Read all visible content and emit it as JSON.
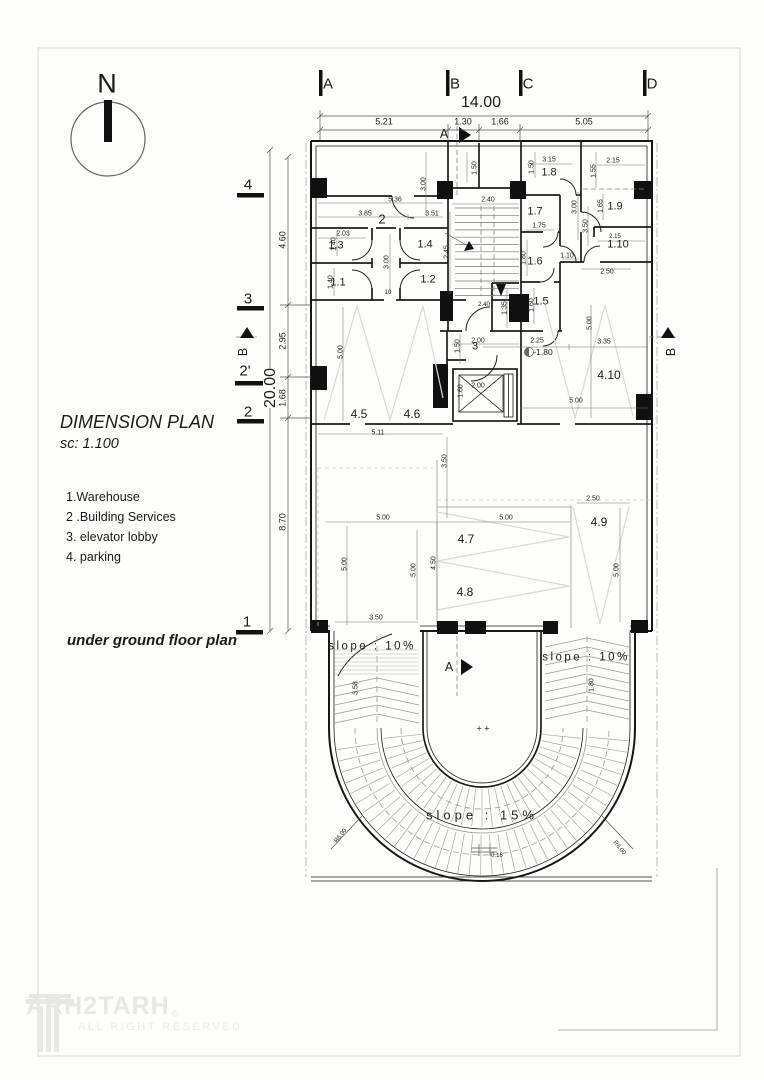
{
  "page": {
    "title": "DIMENSION PLAN",
    "scale": "sc: 1.100",
    "caption": "under ground floor plan"
  },
  "north": {
    "label": "N"
  },
  "legend": {
    "items": [
      "1.Warehouse",
      "2 .Building Services",
      "3. elevator lobby",
      "4. parking"
    ]
  },
  "watermark": {
    "brand": "ARH2TARH",
    "copyright": "©",
    "tagline": "ALL RIGHT RESERVED"
  },
  "annotations": {
    "grid_top": [
      {
        "t": "A",
        "x": 328,
        "y": 84
      },
      {
        "t": "B",
        "x": 455,
        "y": 84
      },
      {
        "t": "C",
        "x": 528,
        "y": 84
      },
      {
        "t": "D",
        "x": 652,
        "y": 84
      }
    ],
    "grid_left": [
      {
        "t": "4",
        "x": 248,
        "y": 185
      },
      {
        "t": "3",
        "x": 248,
        "y": 299
      },
      {
        "t": "2'",
        "x": 245,
        "y": 371
      },
      {
        "t": "2",
        "x": 248,
        "y": 412
      },
      {
        "t": "1",
        "x": 247,
        "y": 622
      }
    ],
    "big": [
      {
        "t": "14.00",
        "x": 481,
        "y": 103
      },
      {
        "t": "20.00",
        "x": 271,
        "y": 388,
        "r": -90,
        "bg": 1
      }
    ],
    "dims": [
      {
        "t": "5.21",
        "x": 384,
        "y": 122,
        "s": 9
      },
      {
        "t": "1.30",
        "x": 463,
        "y": 122,
        "s": 9
      },
      {
        "t": "1.66",
        "x": 500,
        "y": 122,
        "s": 9
      },
      {
        "t": "5.05",
        "x": 584,
        "y": 122,
        "s": 9
      },
      {
        "t": "4.60",
        "x": 283,
        "y": 240,
        "r": -90,
        "s": 9
      },
      {
        "t": "2.95",
        "x": 283,
        "y": 341,
        "r": -90,
        "s": 9
      },
      {
        "t": "1.68",
        "x": 283,
        "y": 398,
        "r": -90,
        "s": 9
      },
      {
        "t": "8.70",
        "x": 283,
        "y": 522,
        "r": -90,
        "s": 9
      },
      {
        "t": "5.36",
        "x": 395,
        "y": 200
      },
      {
        "t": "3.85",
        "x": 365,
        "y": 214
      },
      {
        "t": "3.51",
        "x": 432,
        "y": 214
      },
      {
        "t": "3.00",
        "x": 424,
        "y": 184,
        "r": -90
      },
      {
        "t": "2.03",
        "x": 343,
        "y": 234
      },
      {
        "t": "1.40",
        "x": 334,
        "y": 244,
        "r": -90
      },
      {
        "t": "1.40",
        "x": 331,
        "y": 282,
        "r": -90
      },
      {
        "t": "3.00",
        "x": 387,
        "y": 262,
        "r": -90
      },
      {
        "t": "10",
        "x": 388,
        "y": 293,
        "s": 6
      },
      {
        "t": "2.40",
        "x": 488,
        "y": 200
      },
      {
        "t": "2.45",
        "x": 447,
        "y": 252,
        "r": -90
      },
      {
        "t": "2.40",
        "x": 484,
        "y": 305,
        "s": 6
      },
      {
        "t": "1.50",
        "x": 475,
        "y": 168,
        "r": -90
      },
      {
        "t": "3.15",
        "x": 549,
        "y": 160
      },
      {
        "t": "1.50",
        "x": 532,
        "y": 167,
        "r": -90
      },
      {
        "t": "1.75",
        "x": 539,
        "y": 226
      },
      {
        "t": "3.00",
        "x": 575,
        "y": 207,
        "r": -90
      },
      {
        "t": "3.50",
        "x": 586,
        "y": 226,
        "r": -90
      },
      {
        "t": "2.15",
        "x": 613,
        "y": 161
      },
      {
        "t": "1.55",
        "x": 594,
        "y": 171,
        "r": -90
      },
      {
        "t": "1.65",
        "x": 601,
        "y": 206,
        "r": -90
      },
      {
        "t": "2.15",
        "x": 615,
        "y": 237,
        "s": 6
      },
      {
        "t": "2.50",
        "x": 607,
        "y": 272
      },
      {
        "t": "1.10",
        "x": 567,
        "y": 256
      },
      {
        "t": "1.80",
        "x": 524,
        "y": 258,
        "r": -90
      },
      {
        "t": "1.35",
        "x": 505,
        "y": 308,
        "r": -90
      },
      {
        "t": "1.60",
        "x": 532,
        "y": 305,
        "r": -90
      },
      {
        "t": "2.25",
        "x": 537,
        "y": 341
      },
      {
        "t": "2.00",
        "x": 478,
        "y": 341
      },
      {
        "t": "1.50",
        "x": 458,
        "y": 346,
        "r": -90
      },
      {
        "t": "3.35",
        "x": 604,
        "y": 342
      },
      {
        "t": "5.00",
        "x": 590,
        "y": 323,
        "r": -90
      },
      {
        "t": "2.00",
        "x": 478,
        "y": 386
      },
      {
        "t": "1.60",
        "x": 461,
        "y": 391,
        "r": -90
      },
      {
        "t": "5.00",
        "x": 576,
        "y": 401
      },
      {
        "t": "5.00",
        "x": 341,
        "y": 352,
        "r": -90
      },
      {
        "t": "5.11",
        "x": 378,
        "y": 433
      },
      {
        "t": "3.50",
        "x": 445,
        "y": 461,
        "r": -90
      },
      {
        "t": "5.00",
        "x": 383,
        "y": 518
      },
      {
        "t": "5.00",
        "x": 345,
        "y": 564,
        "r": -90
      },
      {
        "t": "5.00",
        "x": 414,
        "y": 570,
        "r": -90
      },
      {
        "t": "4.50",
        "x": 434,
        "y": 563,
        "r": -90
      },
      {
        "t": "3.50",
        "x": 376,
        "y": 618
      },
      {
        "t": "2.50",
        "x": 593,
        "y": 499
      },
      {
        "t": "5.00",
        "x": 506,
        "y": 518
      },
      {
        "t": "5.00",
        "x": 617,
        "y": 570,
        "r": -90
      },
      {
        "t": "3.58",
        "x": 356,
        "y": 688,
        "r": -90
      },
      {
        "t": "1.80",
        "x": 592,
        "y": 685,
        "r": -90
      },
      {
        "t": "R6.00",
        "x": 341,
        "y": 836,
        "r": -52,
        "s": 6
      },
      {
        "t": "R6.00",
        "x": 619,
        "y": 848,
        "r": 52,
        "s": 6
      },
      {
        "t": "0.16",
        "x": 497,
        "y": 856,
        "s": 6
      }
    ],
    "rooms": [
      {
        "t": "2",
        "x": 382,
        "y": 219,
        "s": 13
      },
      {
        "t": "1.3",
        "x": 336,
        "y": 246
      },
      {
        "t": "1.4",
        "x": 425,
        "y": 245
      },
      {
        "t": "1.1",
        "x": 338,
        "y": 283
      },
      {
        "t": "1.2",
        "x": 428,
        "y": 280
      },
      {
        "t": "1.8",
        "x": 549,
        "y": 173
      },
      {
        "t": "1.7",
        "x": 535,
        "y": 212
      },
      {
        "t": "1.9",
        "x": 615,
        "y": 207
      },
      {
        "t": "1.6",
        "x": 535,
        "y": 262
      },
      {
        "t": "1.10",
        "x": 618,
        "y": 245
      },
      {
        "t": "1.5",
        "x": 541,
        "y": 302
      },
      {
        "t": "3",
        "x": 475,
        "y": 347
      },
      {
        "t": "4.10",
        "x": 609,
        "y": 375,
        "s": 12
      },
      {
        "t": "4.5",
        "x": 359,
        "y": 414,
        "s": 12
      },
      {
        "t": "4.6",
        "x": 412,
        "y": 414,
        "s": 12
      },
      {
        "t": "4.7",
        "x": 466,
        "y": 539,
        "s": 12
      },
      {
        "t": "4.8",
        "x": 465,
        "y": 592,
        "s": 12
      },
      {
        "t": "4.9",
        "x": 599,
        "y": 522,
        "s": 12
      }
    ],
    "slopes": [
      {
        "t": "slope : 10%",
        "x": 372,
        "y": 647
      },
      {
        "t": "slope : 10%",
        "x": 586,
        "y": 658
      },
      {
        "t": "slope : 15%",
        "x": 482,
        "y": 815,
        "s": 13,
        "ls": 4
      }
    ],
    "sections": [
      {
        "t": "A",
        "x": 444,
        "y": 134
      },
      {
        "t": "A",
        "x": 449,
        "y": 667
      },
      {
        "t": "B",
        "x": 243,
        "y": 352,
        "r": -90
      },
      {
        "t": "B",
        "x": 671,
        "y": 352,
        "r": -90
      }
    ],
    "marks": [
      {
        "t": "-1.80",
        "x": 543,
        "y": 352,
        "s": 8.5
      },
      {
        "t": "+ +",
        "x": 483,
        "y": 729,
        "s": 9
      }
    ]
  }
}
